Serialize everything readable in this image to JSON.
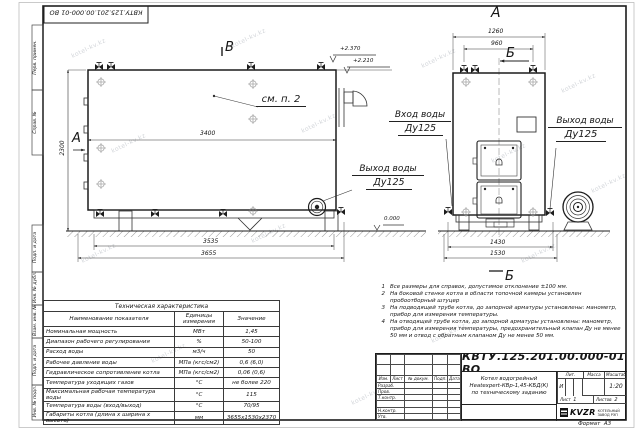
{
  "watermark": "kotel-kv.kz",
  "frame": {
    "top_stamp": "КВТУ.125.201.00.000-01 ВО",
    "margin_labels": [
      "Перв. примен.",
      "Справ. №",
      "Подп. и дата",
      "Инв. № дубл.",
      "Взам. инв. №",
      "Подп. и дата",
      "Инв. № подл."
    ]
  },
  "main_view": {
    "view_letter_left": "А",
    "section_letter_top": "В",
    "callout_note": "см. п. 2",
    "dim_inner_width": "3400",
    "dim_height": "2300",
    "dim_frame": "3535",
    "dim_overall": "3655",
    "elev_top_1": "+2.370",
    "elev_top_2": "+2.210",
    "elev_zero": "0.000",
    "outlet_label": "Выход воды",
    "outlet_dn": "Ду125"
  },
  "front_view": {
    "view_title": "А",
    "dim_top_outer": "1260",
    "dim_top_inner": "960",
    "section_letter_top": "Б",
    "section_letter_bottom": "Б",
    "inlet_label": "Вход воды",
    "inlet_dn": "Ду125",
    "outlet_label": "Выход воды",
    "outlet_dn": "Ду125",
    "dim_bottom_inner": "1430",
    "dim_bottom_outer": "1530"
  },
  "tech_table": {
    "title": "Техническая характеристика",
    "col_name": "Наименование показателя",
    "col_unit": "Единицы измерения",
    "col_value": "Значение",
    "rows": [
      {
        "name": "Номинальная мощность",
        "unit": "МВт",
        "value": "1,45"
      },
      {
        "name": "Диапазон рабочего регулирования",
        "unit": "%",
        "value": "50-100"
      },
      {
        "name": "Расход воды",
        "unit": "м3/ч",
        "value": "50"
      },
      {
        "name": "Рабочее давление воды",
        "unit": "МПа (кгс/см2)",
        "value": "0,6 (6,0)"
      },
      {
        "name": "Гидравлическое сопротивление котла",
        "unit": "МПа (кгс/см2)",
        "value": "0,06 (0,6)"
      },
      {
        "name": "Температура уходящих газов",
        "unit": "°С",
        "value": "не более 220"
      },
      {
        "name": "Максимальная рабочая температура воды",
        "unit": "°С",
        "value": "115"
      },
      {
        "name": "Температура воды (вход/выход)",
        "unit": "°С",
        "value": "70/95"
      },
      {
        "name": "Габариты котла (длина х ширина х высота)",
        "unit": "мм",
        "value": "3655х1530х2370"
      }
    ]
  },
  "notes": {
    "items": [
      {
        "num": "1",
        "text": "Все размеры для справок, допустимое отклонение ±100 мм."
      },
      {
        "num": "2",
        "text": "На боковой стенке котла в области топочной камеры установлен пробоотборный штуцер"
      },
      {
        "num": "3",
        "text": "На подводящей трубе котла, до запорной арматуры установлены: манометр, прибор для измерения температуры."
      },
      {
        "num": "4",
        "text": "На отводящей трубе котла, до запорной арматуры установлены: манометр, прибор для измерения температуры, предохранительный клапан Ду не менее 50 мм и отвод с обратным клапаном Ду не менее 50 мм."
      }
    ]
  },
  "title_block": {
    "doc_number": "КВТУ.125.201.00.000-01 ВО",
    "name_line1": "Котел водогрейный",
    "name_line2": "Heatexpert-КВр-1,45-КБД(К)",
    "name_line3": "по техническому заданию",
    "lit_header": "Лит.",
    "mass_header": "Масса",
    "scale_header": "Масштаб",
    "lit_value": "И",
    "scale_value": "1:20",
    "sheet_label": "Лист",
    "sheet_value": "1",
    "sheets_label": "Листов",
    "sheets_value": "2",
    "col_izm": "Изм.",
    "col_list": "Лист",
    "col_doc": "№ докум.",
    "col_sign": "Подп.",
    "col_date": "Дата",
    "role_rows": [
      "Разраб.",
      "Пров.",
      "Т.контр.",
      "",
      "Н.контр.",
      "Утв."
    ],
    "logo_text": "KVZR",
    "company_line1": "КОТЕЛЬНЫЙ",
    "company_line2": "ЗАВОД РЭП",
    "format_label": "Формат",
    "format_value": "А3"
  }
}
